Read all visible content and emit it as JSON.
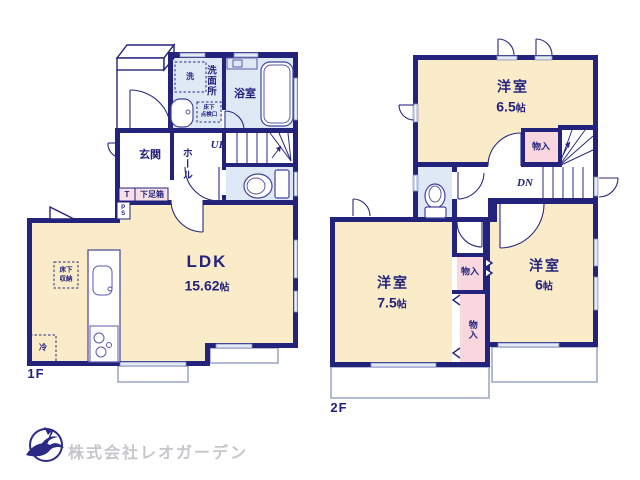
{
  "colors": {
    "wall_navy": "#23237b",
    "room_cream": "#faecc8",
    "wet_blue": "#dfe9f6",
    "closet_pink": "#f8d8de",
    "window_blue": "#ccd5ec",
    "logo_navy": "#2b2b85",
    "logo_text_gray": "#c6c6cb"
  },
  "floor1": {
    "label": "1F",
    "ldk": {
      "name": "LDK",
      "size_num": "15.62",
      "size_unit": "帖"
    },
    "entrance": "玄関",
    "hall": "ホール",
    "washroom": "洗面所",
    "bathroom": "浴室",
    "washer": "洗",
    "inspection_line1": "床下",
    "inspection_line2": "点検口",
    "underfloor_line1": "床下",
    "underfloor_line2": "収納",
    "fridge": "冷",
    "shoe_t": "T",
    "shoebox": "下足箱",
    "ps": "PS",
    "stairs": "UP"
  },
  "floor2": {
    "label": "2F",
    "room_65": {
      "name": "洋室",
      "size_num": "6.5",
      "size_unit": "帖"
    },
    "room_75": {
      "name": "洋室",
      "size_num": "7.5",
      "size_unit": "帖"
    },
    "room_6": {
      "name": "洋室",
      "size_num": "6",
      "size_unit": "帖"
    },
    "closet_top": "物入",
    "closet_mid": "物入",
    "closet_low": "物入",
    "stairs": "DN"
  },
  "footer": {
    "company": "株式会社レオガーデン"
  }
}
